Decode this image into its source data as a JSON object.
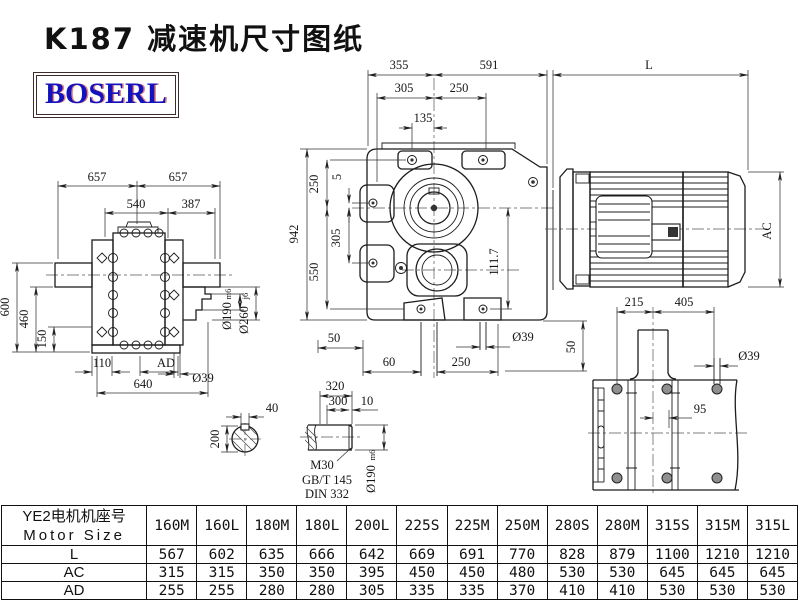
{
  "title": "K187 减速机尺寸图纸",
  "logo": "BOSERL",
  "colors": {
    "logo_text": "#1313bd",
    "logo_border": "#3f2b29",
    "line": "#1c1c1c"
  },
  "front_view": {
    "d355": "355",
    "d591": "591",
    "dL": "L",
    "d305": "305",
    "d250": "250",
    "d135": "135",
    "d942": "942",
    "v250": "250",
    "v5": "5",
    "v305": "305",
    "v550": "550",
    "d111_7": "111.7",
    "d50_left": "50",
    "d60": "60",
    "d250_bottom": "250",
    "d39": "Ø39",
    "d50_right": "50"
  },
  "motor_view": {
    "dAC": "AC"
  },
  "left_view": {
    "d657_l": "657",
    "d657_r": "657",
    "d540": "540",
    "d387": "387",
    "d600": "600",
    "d460": "460",
    "d150": "150",
    "d110": "110",
    "dAD": "AD",
    "d640": "640",
    "d39": "Ø39",
    "d190": "Ø190",
    "d190_fit": "m6",
    "d260": "Ø260",
    "d260_fit": "j6"
  },
  "base_view": {
    "d215": "215",
    "d405": "405",
    "d95": "95",
    "d39": "Ø39"
  },
  "shaft_section": {
    "d40": "40",
    "d200": "200"
  },
  "shaft_end": {
    "d320": "320",
    "d300": "300",
    "d10": "10",
    "thread": "M30",
    "std1": "GB/T 145",
    "std2": "DIN 332",
    "d190": "Ø190",
    "d190_fit": "m6"
  },
  "table": {
    "header_cn": "YE2电机机座号",
    "header_en": "Motor Size",
    "columns": [
      "160M",
      "160L",
      "180M",
      "180L",
      "200L",
      "225S",
      "225M",
      "250M",
      "280S",
      "280M",
      "315S",
      "315M",
      "315L"
    ],
    "rows": [
      {
        "label": "L",
        "values": [
          "567",
          "602",
          "635",
          "666",
          "642",
          "669",
          "691",
          "770",
          "828",
          "879",
          "1100",
          "1210",
          "1210"
        ]
      },
      {
        "label": "AC",
        "values": [
          "315",
          "315",
          "350",
          "350",
          "395",
          "450",
          "450",
          "480",
          "530",
          "530",
          "645",
          "645",
          "645"
        ]
      },
      {
        "label": "AD",
        "values": [
          "255",
          "255",
          "280",
          "280",
          "305",
          "335",
          "335",
          "370",
          "410",
          "410",
          "530",
          "530",
          "530"
        ]
      }
    ]
  }
}
